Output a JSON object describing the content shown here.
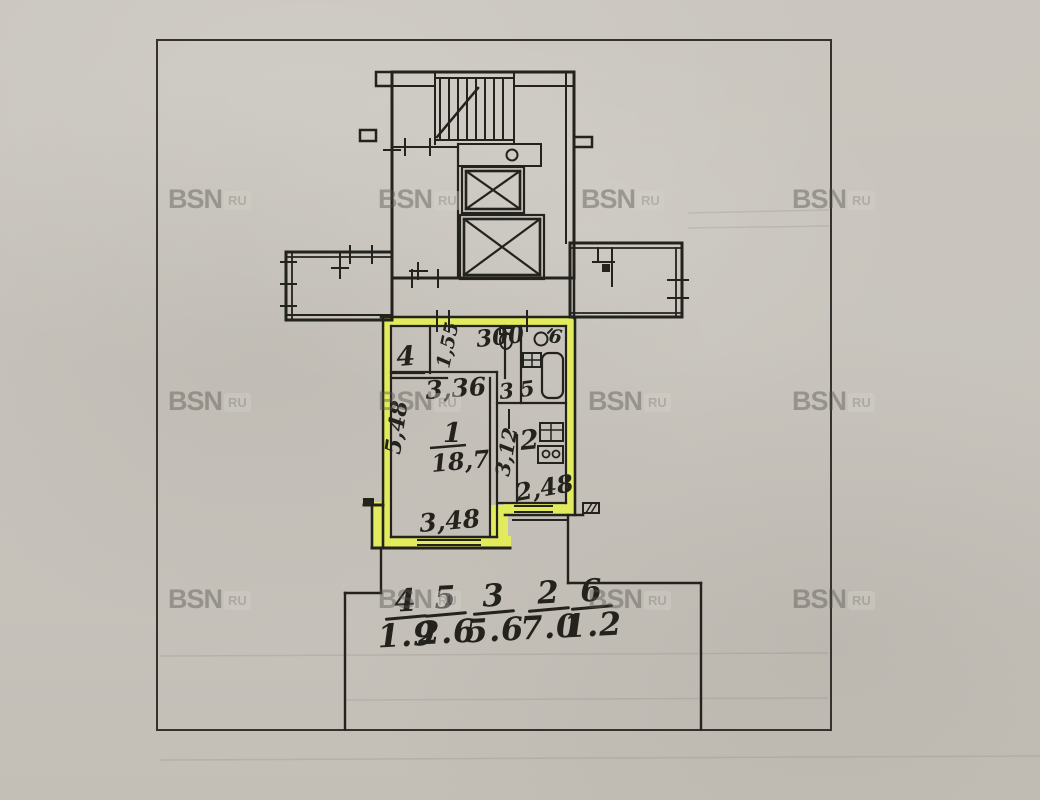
{
  "watermark": {
    "brand": "BSN",
    "suffix": "RU"
  },
  "plan": {
    "labels": {
      "room4_number": "4",
      "room4_dim": "1,55",
      "hall_width_dim": "300",
      "hall_dim": "3,36",
      "hall_number": "3",
      "bath_number": "5",
      "wc_number": "6",
      "room1_number": "1",
      "room1_area": "18,7",
      "room1_depth_dim": "5,48",
      "room1_width_dim": "3,48",
      "kitchen_number": "2",
      "kitchen_depth_dim": "3,12",
      "kitchen_width_dim": "2,48"
    },
    "area_table": [
      {
        "room": "4",
        "area": "1.9"
      },
      {
        "room": "5",
        "area": "2.6"
      },
      {
        "room": "3",
        "area": "5.6"
      },
      {
        "room": "2",
        "area": "7.0"
      },
      {
        "room": "6",
        "area": "1.2"
      }
    ],
    "colors": {
      "highlight": "#e6f054",
      "ink": "#23221d",
      "paper": "#c9c5be"
    }
  }
}
